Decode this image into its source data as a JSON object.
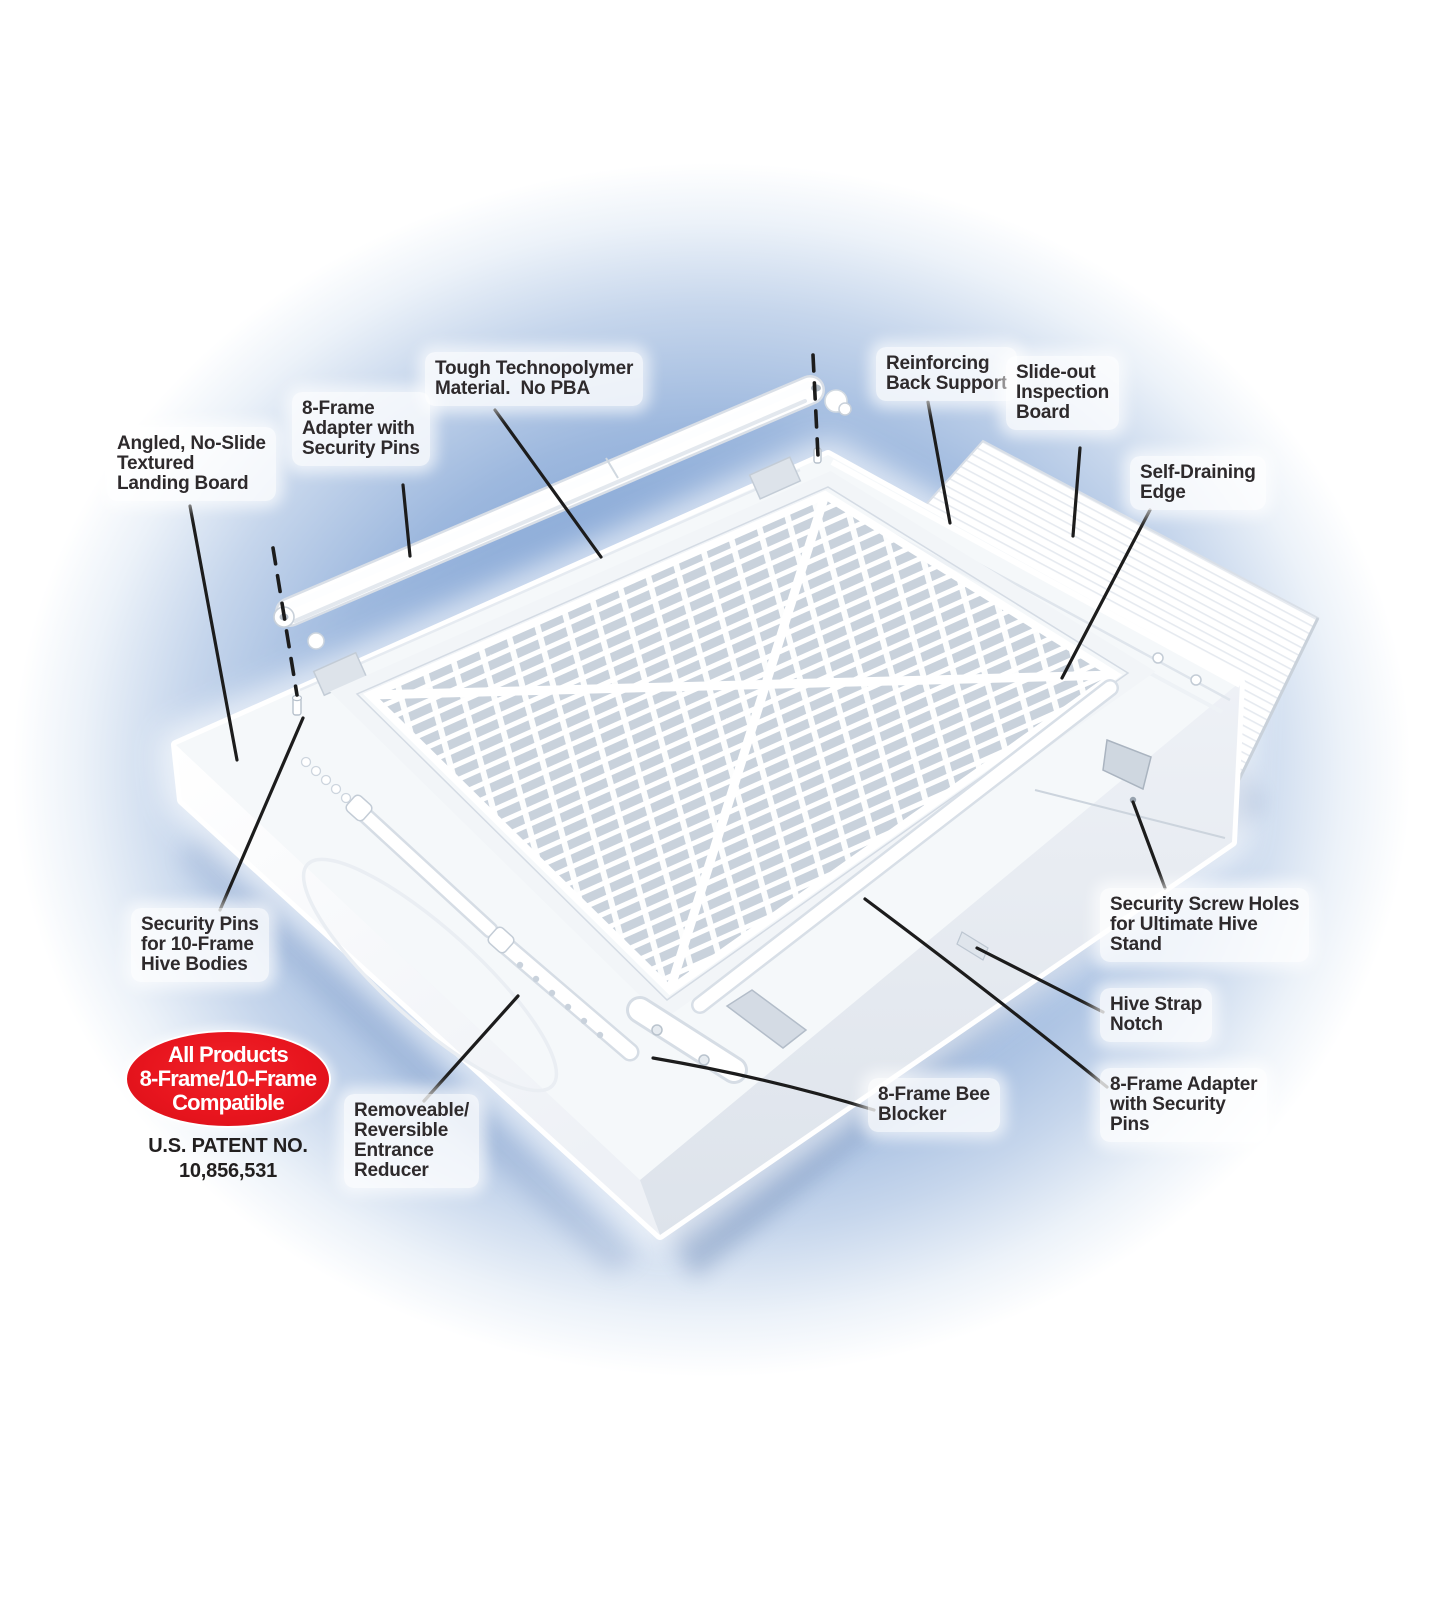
{
  "diagram_title_visible": false,
  "colors": {
    "background_glow_blue": "#7fa2d4",
    "badge_red": "#e8151e",
    "label_text": "#2e2a2c",
    "leader_line": "#1c1c1c",
    "product_white": "#ffffff",
    "mesh_shadow_gray": "#c9d2dc"
  },
  "callouts": {
    "landing_board": {
      "text": "Angled, No-Slide\nTextured\nLanding Board"
    },
    "adapter_top": {
      "text": "8-Frame\nAdapter with\nSecurity Pins"
    },
    "technopolymer": {
      "text": "Tough Technopolymer\nMaterial.  No PBA"
    },
    "back_support": {
      "text": "Reinforcing\nBack Support"
    },
    "inspection_board": {
      "text": "Slide-out\nInspection\nBoard"
    },
    "self_draining": {
      "text": "Self-Draining\nEdge"
    },
    "security_pins_left": {
      "text": "Security Pins\nfor 10-Frame\nHive Bodies"
    },
    "screw_holes": {
      "text": "Security Screw Holes\nfor Ultimate Hive\nStand"
    },
    "strap_notch": {
      "text": "Hive Strap\nNotch"
    },
    "adapter_bottom_right": {
      "text": "8-Frame Adapter\nwith Security\nPins"
    },
    "bee_blocker": {
      "text": "8-Frame Bee\nBlocker"
    },
    "entrance_reducer": {
      "text": "Removeable/\nReversible\nEntrance\nReducer"
    }
  },
  "badge": {
    "line1": "All Products",
    "line2": "8-Frame/10-Frame",
    "line3": "Compatible"
  },
  "patent": {
    "line1": "U.S. PATENT NO.",
    "line2": "10,856,531"
  }
}
